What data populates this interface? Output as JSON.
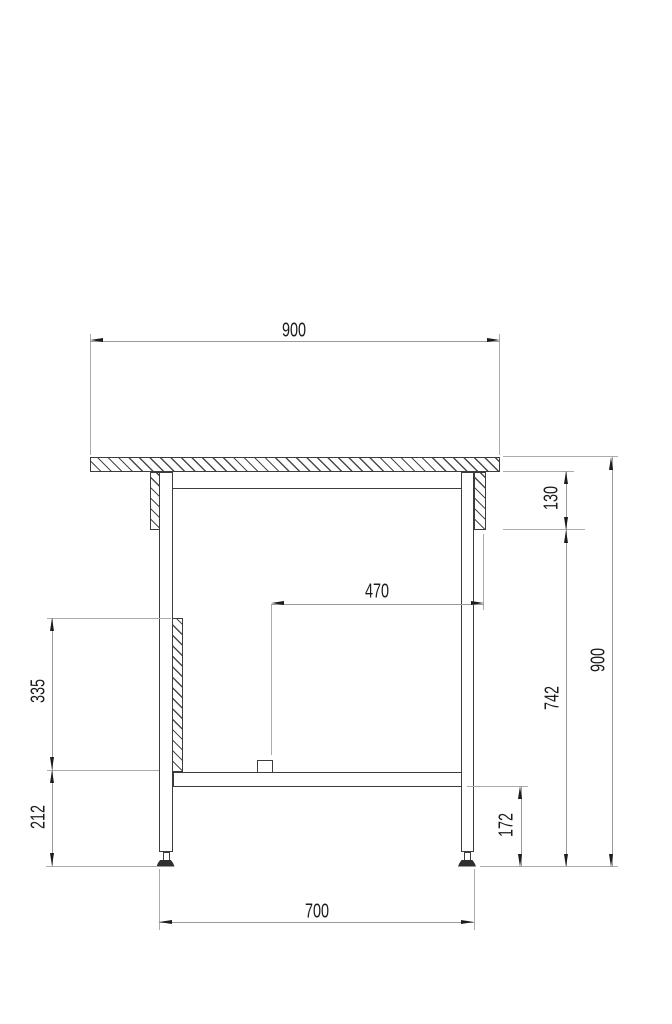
{
  "dimensions": {
    "top_width": "900",
    "apron_drop": "130",
    "block_offset": "470",
    "panel_height": "335",
    "lower_leg_height": "212",
    "under_top_height": "742",
    "overall_height": "900",
    "shelf_floor_gap": "172",
    "leg_span": "700"
  },
  "colors": {
    "object_line": "#3c3c3c",
    "dimension_line": "#9a9a9a",
    "arrow_and_text": "#1c1c1c",
    "background": "#ffffff"
  }
}
